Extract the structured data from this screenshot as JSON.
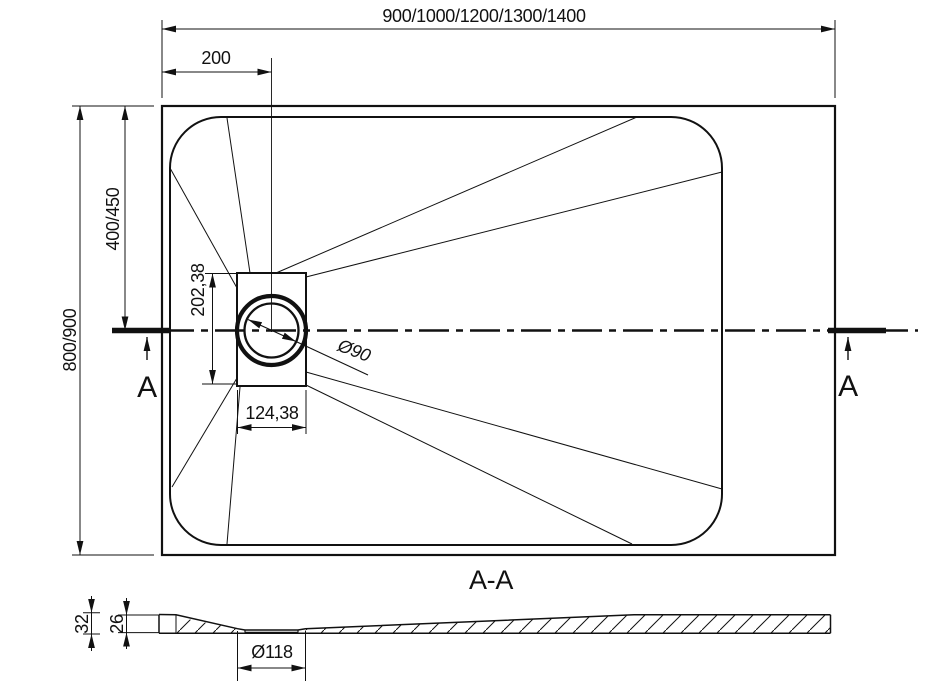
{
  "drawing_title": "shower-tray-technical-drawing",
  "colors": {
    "line": "#111111",
    "background": "#ffffff"
  },
  "plan_view": {
    "overall_width_label": "900/1000/1200/1300/1400",
    "drain_offset_label": "200",
    "overall_depth_label": "800/900",
    "drain_axis_label": "400/450",
    "drain_recess_height_label": "202,38",
    "drain_recess_width_label": "124,38",
    "drain_diameter_label": "Ø90",
    "section_marker_left": "A",
    "section_marker_right": "A"
  },
  "section_view": {
    "title": "A-A",
    "overall_height_label": "32",
    "base_thickness_label": "26",
    "drain_hole_label": "Ø118"
  }
}
